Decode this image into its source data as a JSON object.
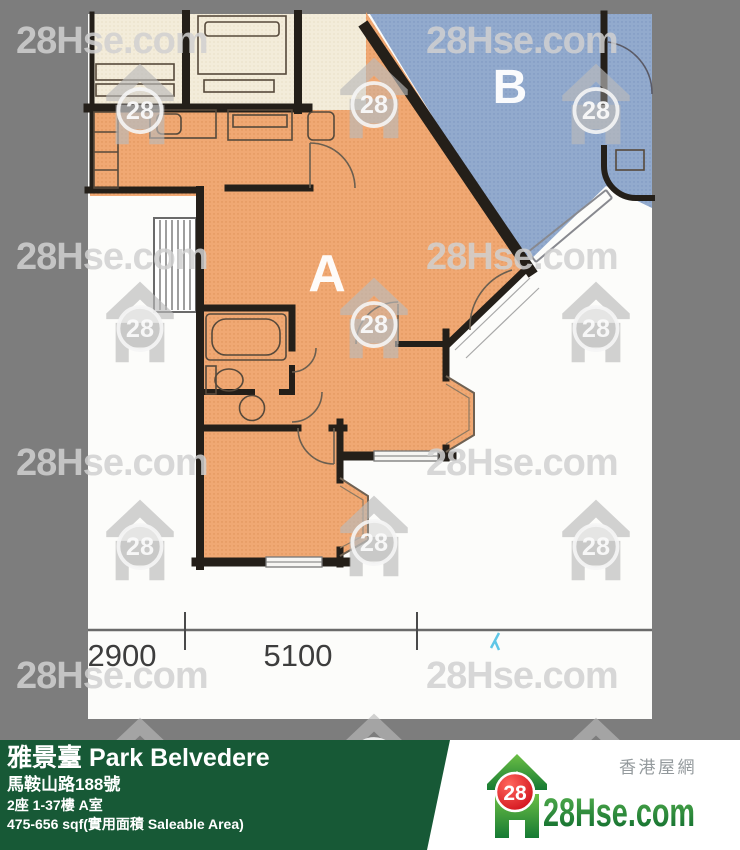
{
  "plan": {
    "unit_a_label": "A",
    "unit_b_label": "B",
    "dim_left": "2900",
    "dim_right": "5100"
  },
  "watermark": {
    "text": "28Hse.com",
    "badge": "28"
  },
  "footer": {
    "building_name": "雅景臺 Park Belvedere",
    "address": "馬鞍山路188號",
    "unit_info": "2座 1-37樓 A室",
    "area_info": "475-656 sqf(實用面積 Saleable Area)"
  },
  "logo": {
    "badge": "28",
    "brand": "28Hse.com",
    "tagline": "香港屋網"
  },
  "colors": {
    "background_gray": "#7d7d7d",
    "plan_paper": "#fcfcfa",
    "unit_a_fill": "#f0a873",
    "unit_b_fill": "#92aacd",
    "bedroom_cream": "#f3ecda",
    "wall": "#241f19",
    "footer_green": "#175936",
    "logo_red": "#d8101c",
    "logo_green": "#1b8a3a",
    "watermark_gray": "#cccccc",
    "pen_mark_cyan": "#5fc6e6"
  }
}
